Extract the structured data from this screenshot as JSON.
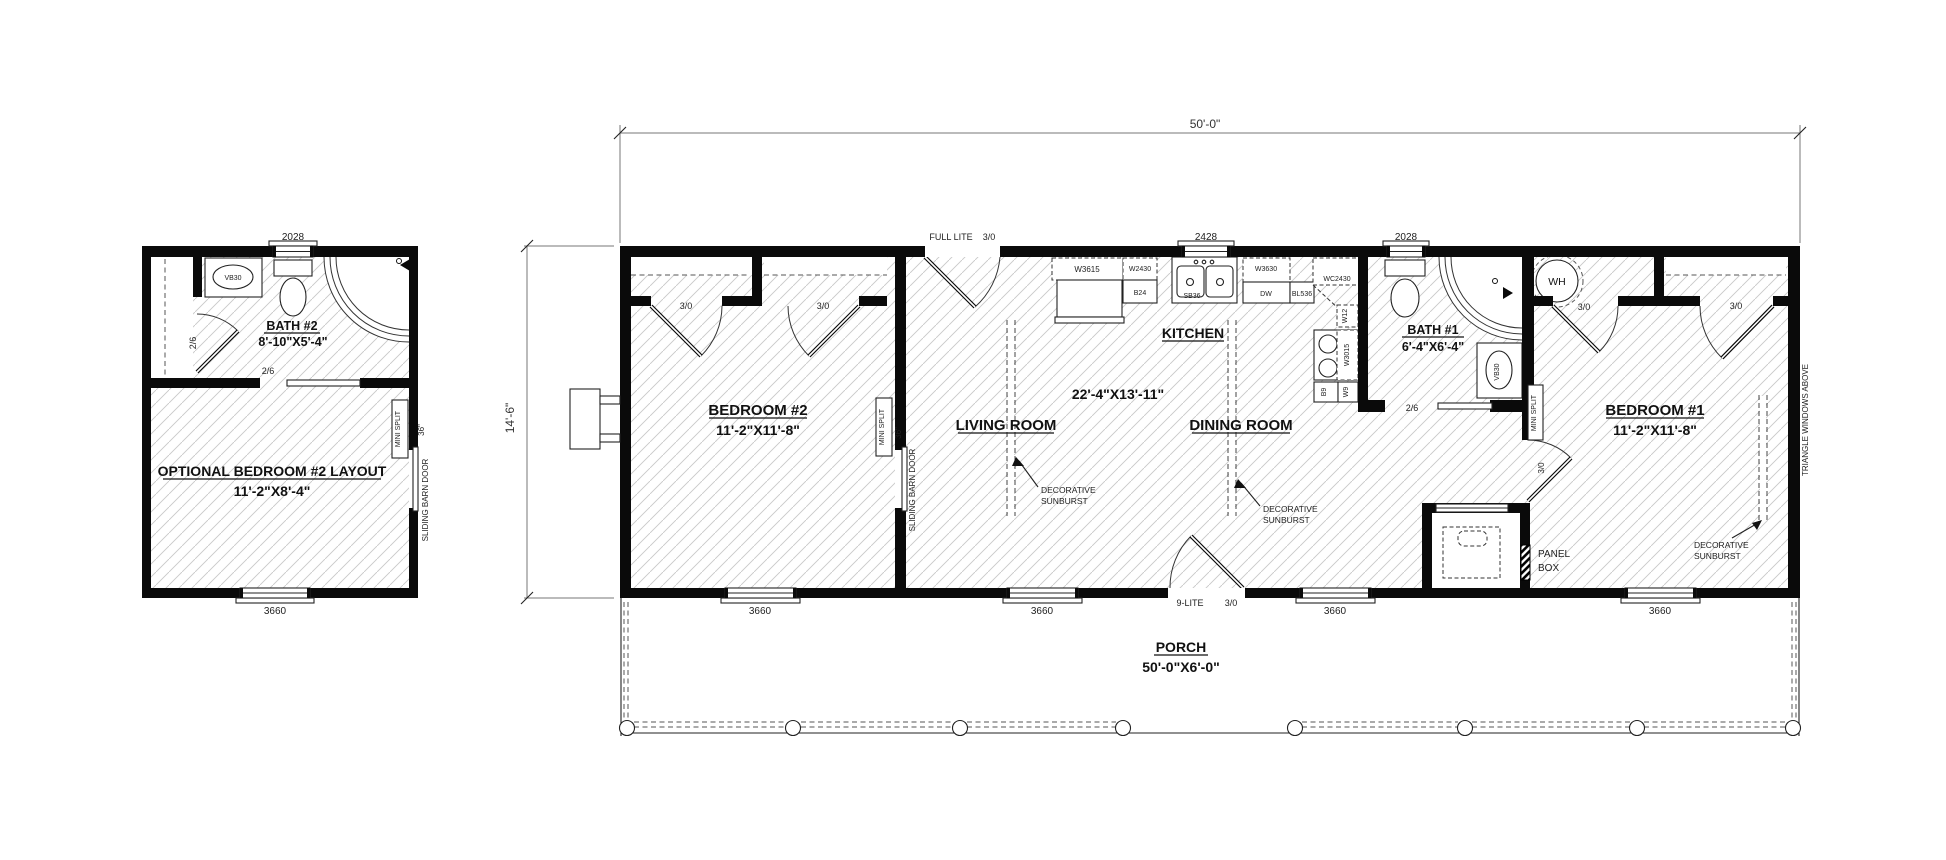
{
  "drawing": {
    "dims": {
      "overall_width": "50'-0\"",
      "overall_depth": "14'-6\""
    },
    "rooms": {
      "optional_bedroom2": {
        "name": "OPTIONAL BEDROOM #2 LAYOUT",
        "size": "11'-2\"X8'-4\""
      },
      "bath2": {
        "name": "BATH #2",
        "size": "8'-10\"X5'-4\""
      },
      "bedroom2": {
        "name": "BEDROOM #2",
        "size": "11'-2\"X11'-8\""
      },
      "living_room": {
        "name": "LIVING ROOM"
      },
      "kitchen": {
        "name": "KITCHEN",
        "size": "22'-4\"X13'-11\""
      },
      "dining_room": {
        "name": "DINING ROOM"
      },
      "bath1": {
        "name": "BATH #1",
        "size": "6'-4\"X6'-4\""
      },
      "bedroom1": {
        "name": "BEDROOM #1",
        "size": "11'-2\"X11'-8\""
      },
      "porch": {
        "name": "PORCH",
        "size": "50'-0\"X6'-0\""
      }
    },
    "doors": {
      "d30": "3/0",
      "d26": "2/6",
      "full_lite": "FULL LITE",
      "nine_lite": "9-LITE"
    },
    "windows": {
      "w2028": "2028",
      "w2428": "2428",
      "w3660": "3660"
    },
    "cabinets": {
      "w3615": "W3615",
      "w2430": "W2430",
      "b24": "B24",
      "sb36": "SB36",
      "w3630": "W3630",
      "dw": "DW",
      "bl536": "BL536",
      "wc2430": "WC2430",
      "w12": "W12",
      "w3015": "W3015",
      "b9": "B9",
      "w9": "W9",
      "vb30": "VB30"
    },
    "annotations": {
      "mini_split": "MINI SPLIT",
      "sliding_barn_door": "SLIDING BARN DOOR",
      "barn_door_size": "36\"",
      "water_heater": "WH",
      "panel_line1": "PANEL",
      "panel_line2": "BOX",
      "decorative": "DECORATIVE",
      "sunburst": "SUNBURST",
      "triangle_windows": "TRIANGLE WINDOWS ABOVE"
    },
    "colors": {
      "wall": "#0a0a0a",
      "hatch": "#c9c9c9",
      "paper": "#ffffff"
    }
  }
}
